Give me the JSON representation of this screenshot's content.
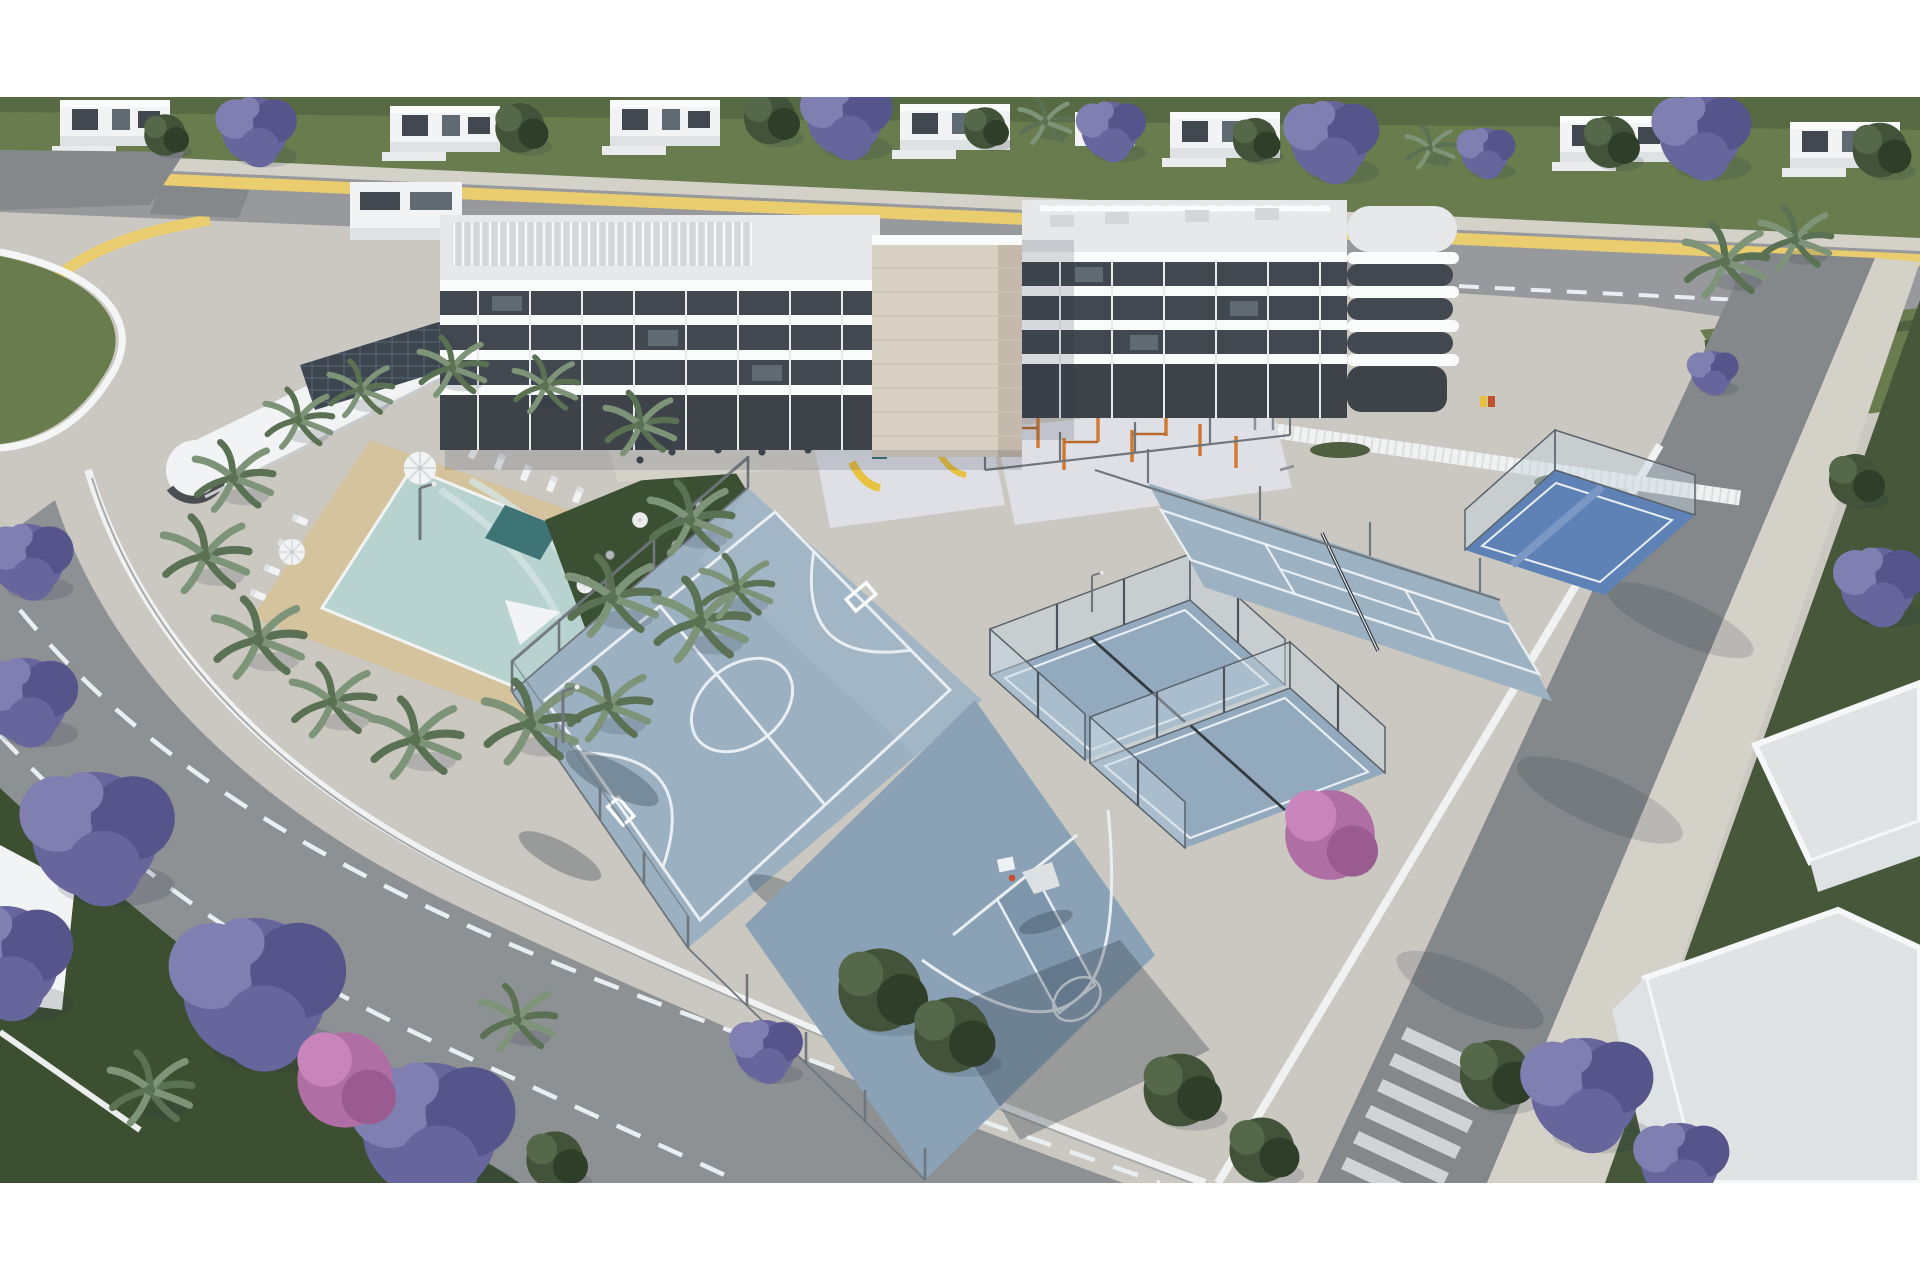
{
  "meta": {
    "type": "aerial-architectural-render",
    "description": "Aerial 3D render of a white residential apartment complex with rooftop terraces, a landscaped pool deck with palms, a playground and calisthenics zone, futsal and basketball courts, glass padel courts, a tennis court, jacaranda-lined streets and a pedestrian crossing.",
    "scene_labels": [
      "residential-building",
      "elevator-tower",
      "annex-wing-solar-roof",
      "swimming-pool",
      "spa-pool",
      "pool-deck",
      "sun-loungers",
      "parasols",
      "garden-terrace",
      "restaurant-terrace",
      "playground",
      "calisthenics-area",
      "futsal-court",
      "basketball-half-court",
      "padel-courts",
      "tennis-court",
      "blue-padel-court",
      "perimeter-fences",
      "streets",
      "crosswalk",
      "jacaranda-trees",
      "palm-trees",
      "villas"
    ]
  },
  "palette": {
    "bg": "#ffffff",
    "basePale": "#cbc8c1",
    "grassTop": "#687c4e",
    "grassDark": "#46573a",
    "lawnDark": "#3c4f31",
    "asphalt": "#97999c",
    "asphaltDark": "#85888b",
    "roadLeft": "#8e9194",
    "stripeYellow": "#e9cd6e",
    "sidewalk": "#d4d1c9",
    "deckSand": "#d5c39e",
    "poolWater": "#b7d2cf",
    "poolLight": "#d3e4e1",
    "spaTeal": "#3f7476",
    "white": "#f2f3f4",
    "whiteShade": "#dfe2e4",
    "roofLight": "#e6e8ea",
    "roofPanel": "#d4d7da",
    "facadeDark": "#42484f",
    "glassBlue": "#5f6a73",
    "towerBeige": "#d9d0c4",
    "towerShade": "#c4b9ab",
    "solarDark": "#3d454e",
    "courtBlue": "#9bb0c1",
    "courtBlueLight": "#abbecd",
    "bballBlue": "#8ba2b6",
    "keyBlue": "#7e96ab",
    "courtLine": "#e8eef2",
    "padelFloor": "#93a9bd",
    "glassWall": "rgba(198,212,224,0.45)",
    "tennisBlue": "#9cb1c2",
    "bluePadel": "#5e81b6",
    "bluePadelLight": "#7b97c4",
    "fenceSteel": "#6f767c",
    "fenceWhite": "#f0f2f2",
    "palmGreen": "#7e9478",
    "palmDark": "#5a7153",
    "treeGreen": "#42533a",
    "treeLight": "#55684a",
    "treeDark": "#2f3e29",
    "jacPurple": "#66659c",
    "jacLight": "#807fb2",
    "jacDark": "#55548b",
    "pinkTree": "#b06fa4",
    "pinkLight": "#c985bb",
    "orangeBar": "#d07a33",
    "slideYellow": "#e8c23f",
    "playFloor": "#dfdfe6",
    "gardenGreen": "#3b5033",
    "tableGray": "#b3b8bb",
    "shadow": "rgba(40,52,66,0.30)",
    "shadowSoft": "rgba(40,52,66,0.16)",
    "crosswalk": "#d8dbdd",
    "hoopRim": "#c0512f",
    "gravelRoof": "#e0e2e3",
    "hedgeGreen": "#4e6040"
  }
}
